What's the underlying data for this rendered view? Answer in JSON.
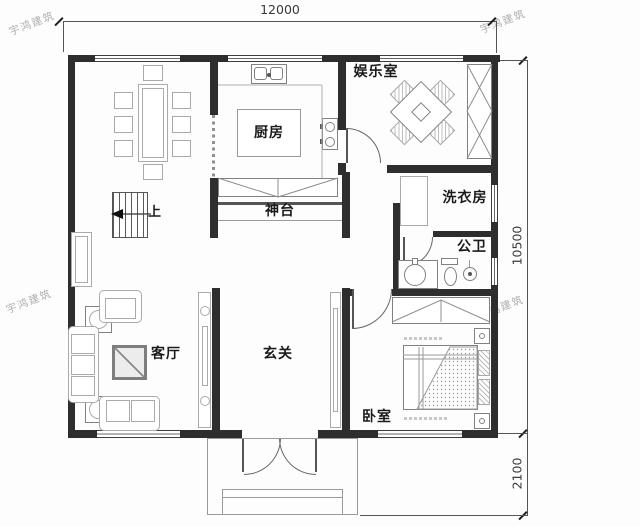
{
  "plan": {
    "watermark": "宇鸿建筑",
    "dims": {
      "width": "12000",
      "height": "10500",
      "porch": "2100"
    },
    "rooms": {
      "entertainment": "娱乐室",
      "kitchen": "厨房",
      "altar": "神台",
      "laundry": "洗衣房",
      "bathroom": "公卫",
      "living": "客厅",
      "foyer": "玄关",
      "bedroom": "卧室",
      "up": "上"
    }
  }
}
